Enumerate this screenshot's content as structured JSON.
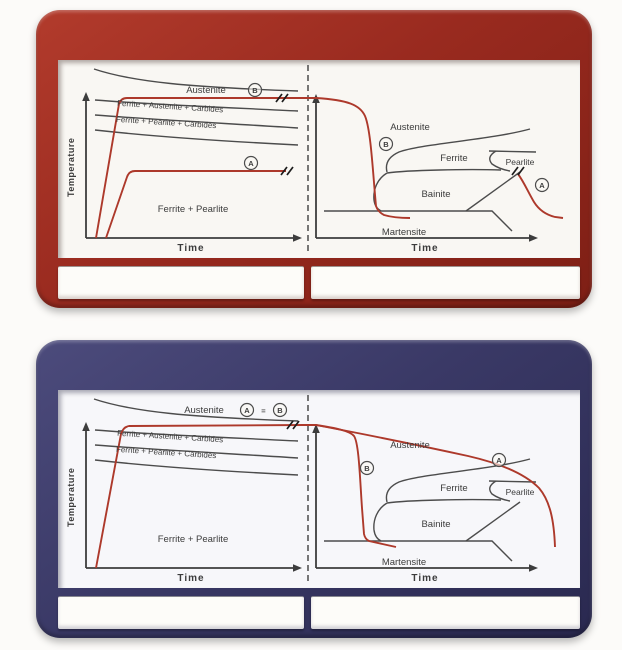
{
  "colors": {
    "top_frame": "#992a1f",
    "bottom_frame": "#3a3966",
    "diagram_line_gray": "#4c4c4c",
    "path_red": "#ad392b",
    "screen_bg": "#f9f7f3"
  },
  "panels": [
    {
      "id": "top",
      "left_diagram": {
        "y_axis_label": "Temperature",
        "x_axis_label": "Time",
        "region_austenite": "Austenite",
        "curve_label_1": "Ferrite + Austenite + Carbides",
        "curve_label_2": "Ferrite + Pearlite + Carbides",
        "region_bottom": "Ferrite + Pearlite",
        "marker_a": "A",
        "marker_b": "B"
      },
      "right_diagram": {
        "x_axis_label": "Time",
        "region_austenite": "Austenite",
        "region_ferrite": "Ferrite",
        "region_pearlite": "Pearlite",
        "region_bainite": "Bainite",
        "region_martensite": "Martensite",
        "marker_a": "A",
        "marker_b": "B"
      },
      "captions": [
        "",
        ""
      ]
    },
    {
      "id": "bottom",
      "left_diagram": {
        "y_axis_label": "Temperature",
        "x_axis_label": "Time",
        "region_austenite": "Austenite",
        "curve_label_1": "Ferrite + Austenite + Carbides",
        "curve_label_2": "Ferrite + Pearlite + Carbides",
        "region_bottom": "Ferrite + Pearlite",
        "marker_a": "A",
        "equals": "=",
        "marker_b": "B"
      },
      "right_diagram": {
        "x_axis_label": "Time",
        "region_austenite": "Austenite",
        "region_ferrite": "Ferrite",
        "region_pearlite": "Pearlite",
        "region_bainite": "Bainite",
        "region_martensite": "Martensite",
        "marker_a": "A",
        "marker_b": "B"
      },
      "captions": [
        "",
        ""
      ]
    }
  ]
}
